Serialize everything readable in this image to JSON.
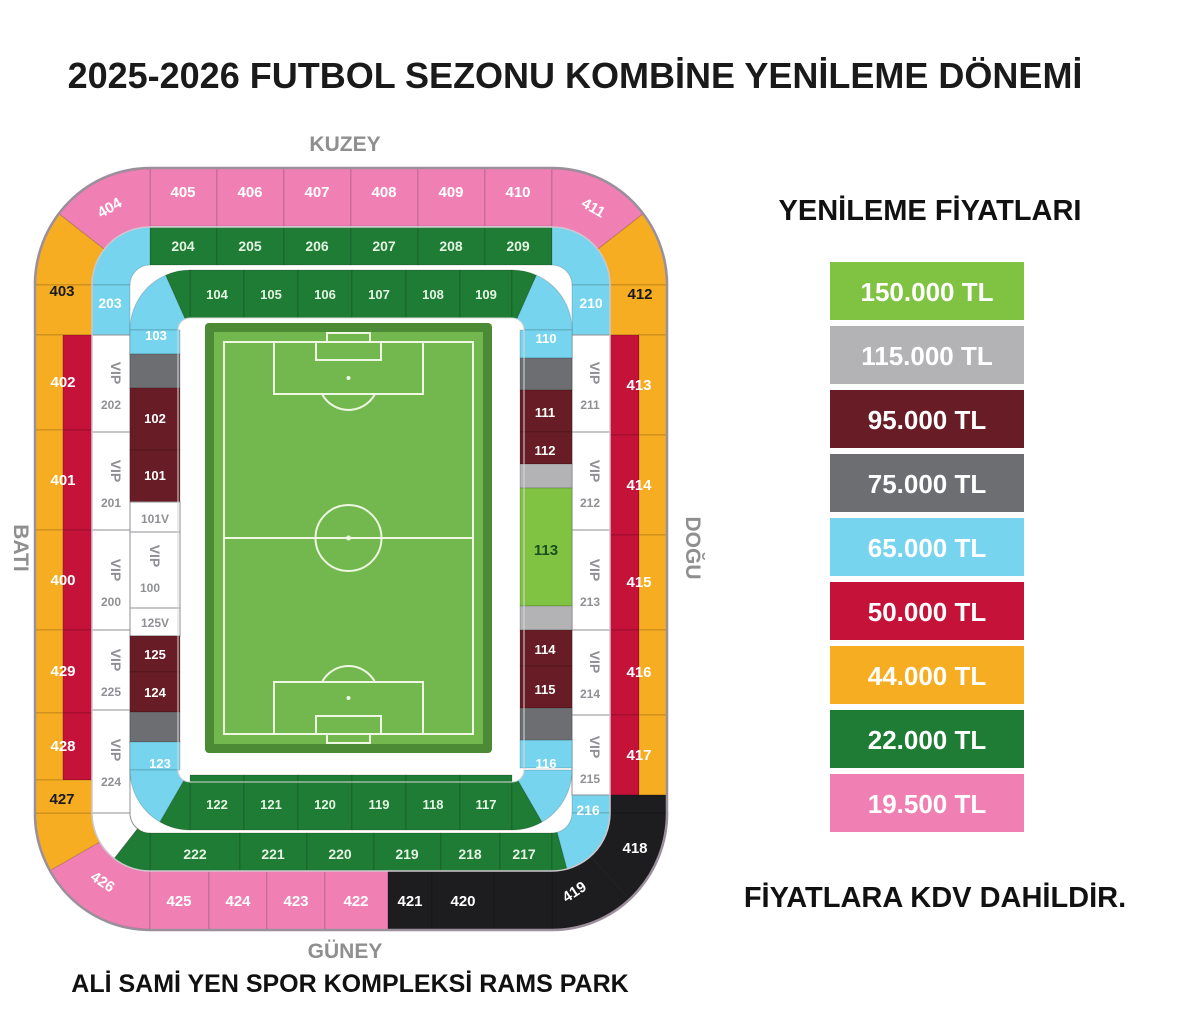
{
  "title": "2025-2026 FUTBOL SEZONU KOMBİNE YENİLEME DÖNEMİ",
  "venue": "ALİ SAMİ YEN SPOR KOMPLEKSİ RAMS PARK",
  "compass": {
    "north": "KUZEY",
    "south": "GÜNEY",
    "west": "BATI",
    "east": "DOĞU"
  },
  "legend": {
    "title": "YENİLEME FİYATLARI",
    "note": "FİYATLARA KDV DAHİLDİR.",
    "items": [
      {
        "key": "g150",
        "price": "150.000 TL",
        "color": "#80c342"
      },
      {
        "key": "s115",
        "price": "115.000 TL",
        "color": "#b3b3b5"
      },
      {
        "key": "m95",
        "price": "95.000 TL",
        "color": "#681c25"
      },
      {
        "key": "g75",
        "price": "75.000 TL",
        "color": "#6d6e71"
      },
      {
        "key": "b65",
        "price": "65.000 TL",
        "color": "#76d4ee"
      },
      {
        "key": "c50",
        "price": "50.000 TL",
        "color": "#c41239"
      },
      {
        "key": "a44",
        "price": "44.000 TL",
        "color": "#f6ad22"
      },
      {
        "key": "g22",
        "price": "22.000 TL",
        "color": "#1e7c35"
      },
      {
        "key": "p19",
        "price": "19.500 TL",
        "color": "#f080b4"
      }
    ]
  },
  "other_colors": {
    "vip": "#ffffff",
    "blk": "#1d1d1f"
  },
  "stadium": {
    "sections": {
      "405": {
        "label": "405",
        "key": "p19"
      },
      "406": {
        "label": "406",
        "key": "p19"
      },
      "407": {
        "label": "407",
        "key": "p19"
      },
      "408": {
        "label": "408",
        "key": "p19"
      },
      "409": {
        "label": "409",
        "key": "p19"
      },
      "410": {
        "label": "410",
        "key": "p19"
      },
      "404": {
        "label": "404",
        "key": "p19"
      },
      "411": {
        "label": "411",
        "key": "p19"
      },
      "403": {
        "label": "403",
        "key": "a44"
      },
      "412": {
        "label": "412",
        "key": "a44"
      },
      "402": {
        "label": "402",
        "keys": [
          "a44",
          "c50"
        ]
      },
      "401": {
        "label": "401",
        "keys": [
          "a44",
          "c50"
        ]
      },
      "400": {
        "label": "400",
        "keys": [
          "a44",
          "c50"
        ]
      },
      "429": {
        "label": "429",
        "keys": [
          "a44",
          "c50"
        ]
      },
      "428": {
        "label": "428",
        "keys": [
          "a44",
          "c50"
        ]
      },
      "427": {
        "label": "427",
        "key": "a44"
      },
      "426": {
        "label": "426",
        "key": "p19"
      },
      "425": {
        "label": "425",
        "key": "p19"
      },
      "424": {
        "label": "424",
        "key": "p19"
      },
      "423": {
        "label": "423",
        "key": "p19"
      },
      "422": {
        "label": "422",
        "key": "p19"
      },
      "421": {
        "label": "421",
        "key": "blk"
      },
      "420": {
        "label": "420",
        "key": "blk"
      },
      "419": {
        "label": "419",
        "key": "blk"
      },
      "418": {
        "label": "418",
        "key": "blk"
      },
      "413": {
        "label": "413",
        "keys": [
          "a44",
          "c50"
        ]
      },
      "414": {
        "label": "414",
        "keys": [
          "a44",
          "c50"
        ]
      },
      "415": {
        "label": "415",
        "keys": [
          "a44",
          "c50"
        ]
      },
      "416": {
        "label": "416",
        "keys": [
          "a44",
          "c50"
        ]
      },
      "417": {
        "label": "417",
        "keys": [
          "a44",
          "c50"
        ]
      },
      "204": {
        "label": "204",
        "key": "g22"
      },
      "205": {
        "label": "205",
        "key": "g22"
      },
      "206": {
        "label": "206",
        "key": "g22"
      },
      "207": {
        "label": "207",
        "key": "g22"
      },
      "208": {
        "label": "208",
        "key": "g22"
      },
      "209": {
        "label": "209",
        "key": "g22"
      },
      "203": {
        "label": "203",
        "key": "b65"
      },
      "210": {
        "label": "210",
        "key": "b65"
      },
      "202": {
        "label": "VIP 202",
        "key": "vip",
        "vip": true
      },
      "201": {
        "label": "VIP 201",
        "key": "vip",
        "vip": true
      },
      "200": {
        "label": "VIP 200",
        "key": "vip",
        "vip": true
      },
      "225": {
        "label": "VIP 225",
        "key": "vip",
        "vip": true
      },
      "224": {
        "label": "VIP 224",
        "key": "vip",
        "vip": true
      },
      "211": {
        "label": "VIP 211",
        "key": "vip",
        "vip": true
      },
      "212": {
        "label": "VIP 212",
        "key": "vip",
        "vip": true
      },
      "213": {
        "label": "VIP 213",
        "key": "vip",
        "vip": true
      },
      "214": {
        "label": "VIP 214",
        "key": "vip",
        "vip": true
      },
      "215": {
        "label": "VIP 215",
        "key": "vip",
        "vip": true
      },
      "222": {
        "label": "222",
        "key": "g22"
      },
      "221": {
        "label": "221",
        "key": "g22"
      },
      "220": {
        "label": "220",
        "key": "g22"
      },
      "219": {
        "label": "219",
        "key": "g22"
      },
      "218": {
        "label": "218",
        "key": "g22"
      },
      "217": {
        "label": "217",
        "key": "g22"
      },
      "216": {
        "label": "216",
        "key": "b65"
      },
      "104": {
        "label": "104",
        "key": "g22"
      },
      "105": {
        "label": "105",
        "key": "g22"
      },
      "106": {
        "label": "106",
        "key": "g22"
      },
      "107": {
        "label": "107",
        "key": "g22"
      },
      "108": {
        "label": "108",
        "key": "g22"
      },
      "109": {
        "label": "109",
        "key": "g22"
      },
      "103": {
        "label": "103",
        "key": "b65"
      },
      "110": {
        "label": "110",
        "key": "b65"
      },
      "102": {
        "label": "102",
        "key": "m95"
      },
      "101": {
        "label": "101",
        "key": "m95"
      },
      "101V": {
        "label": "101V",
        "key": "vip"
      },
      "100": {
        "label": "VIP 100",
        "key": "vip",
        "vip": true
      },
      "125V": {
        "label": "125V",
        "key": "vip"
      },
      "125": {
        "label": "125",
        "key": "m95"
      },
      "124": {
        "label": "124",
        "key": "m95"
      },
      "123": {
        "label": "123",
        "key": "b65"
      },
      "122": {
        "label": "122",
        "key": "g22"
      },
      "121": {
        "label": "121",
        "key": "g22"
      },
      "120": {
        "label": "120",
        "key": "g22"
      },
      "119": {
        "label": "119",
        "key": "g22"
      },
      "118": {
        "label": "118",
        "key": "g22"
      },
      "117": {
        "label": "117",
        "key": "g22"
      },
      "116": {
        "label": "116",
        "key": "b65"
      },
      "111": {
        "label": "111",
        "key": "m95"
      },
      "112": {
        "label": "112",
        "key": "m95"
      },
      "113": {
        "label": "113",
        "key": "g150"
      },
      "114": {
        "label": "114",
        "key": "m95"
      },
      "115": {
        "label": "115",
        "key": "m95"
      },
      "strip-102t": {
        "label": "",
        "key": "g75"
      },
      "strip-124b": {
        "label": "",
        "key": "g75"
      },
      "strip-111t": {
        "label": "",
        "key": "g75"
      },
      "strip-115b": {
        "label": "",
        "key": "g75"
      },
      "strip-112b": {
        "label": "",
        "key": "s115"
      },
      "strip-114t": {
        "label": "",
        "key": "s115"
      }
    }
  }
}
